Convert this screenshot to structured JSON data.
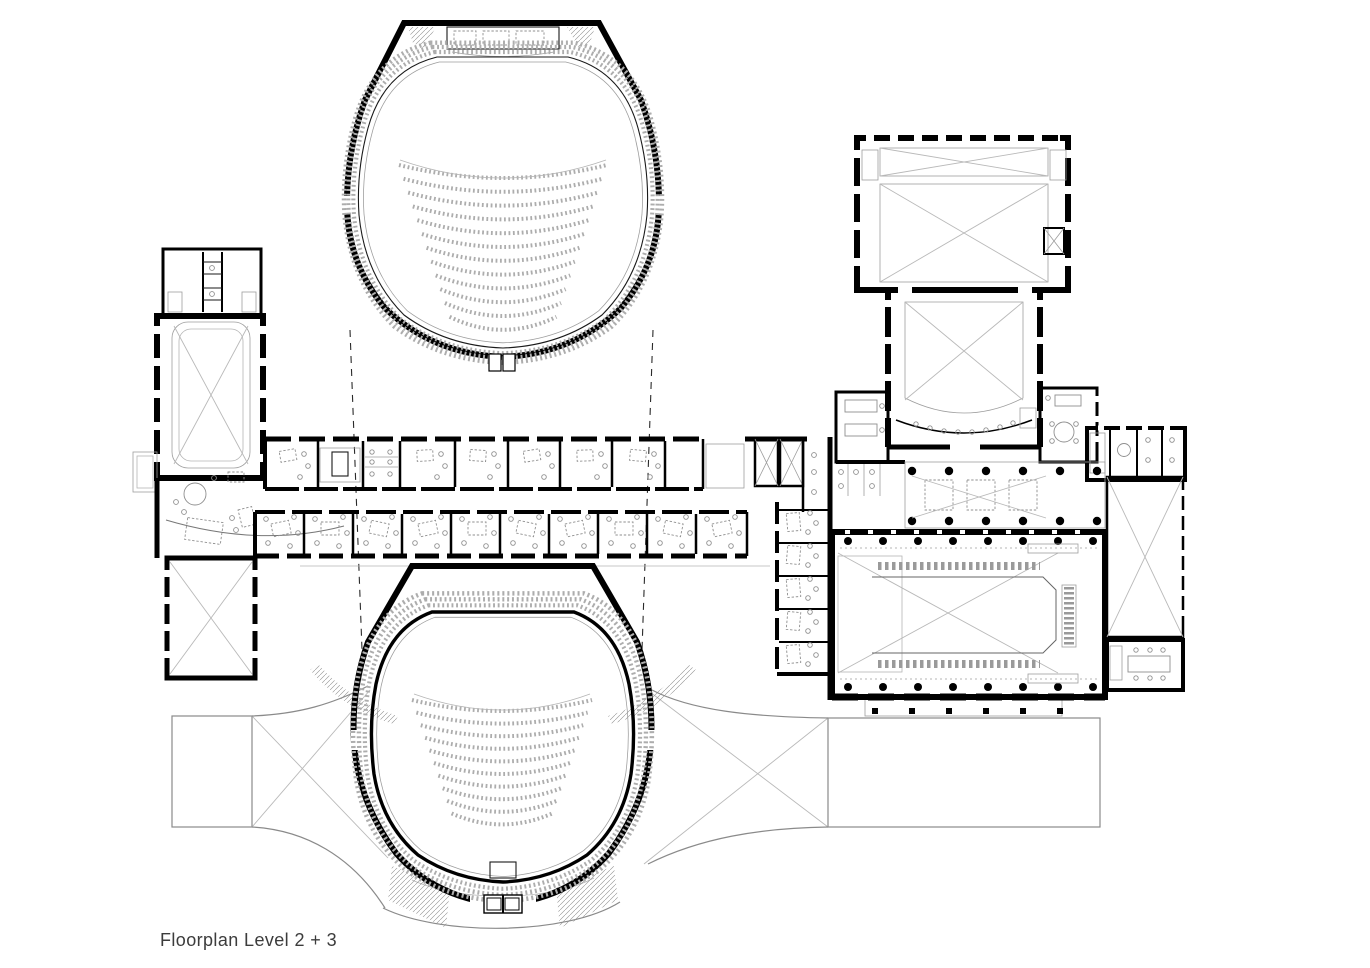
{
  "title": {
    "label": "Floorplan Level 2 + 3"
  },
  "palette": {
    "background": "#ffffff",
    "wall_ink": "#000000",
    "fine_line": "#9d9d9d",
    "plaza_line": "#8a8a8a",
    "label_color": "#3c3c3c"
  },
  "drawing": {
    "type": "architectural-floorplan",
    "components": [
      "upper-auditorium-plan",
      "lower-auditorium-plan",
      "stage-machinery",
      "seating-rows",
      "left-wing",
      "rehearsal-void-crossed",
      "office-corridor",
      "stair-cores",
      "elevator-shafts",
      "stage-tower",
      "main-stage",
      "side-hall",
      "foyer-colonnade",
      "crossed-void-rooms",
      "meeting-rooms",
      "plaza-terraces",
      "projection-lines",
      "entrance-doors"
    ]
  }
}
